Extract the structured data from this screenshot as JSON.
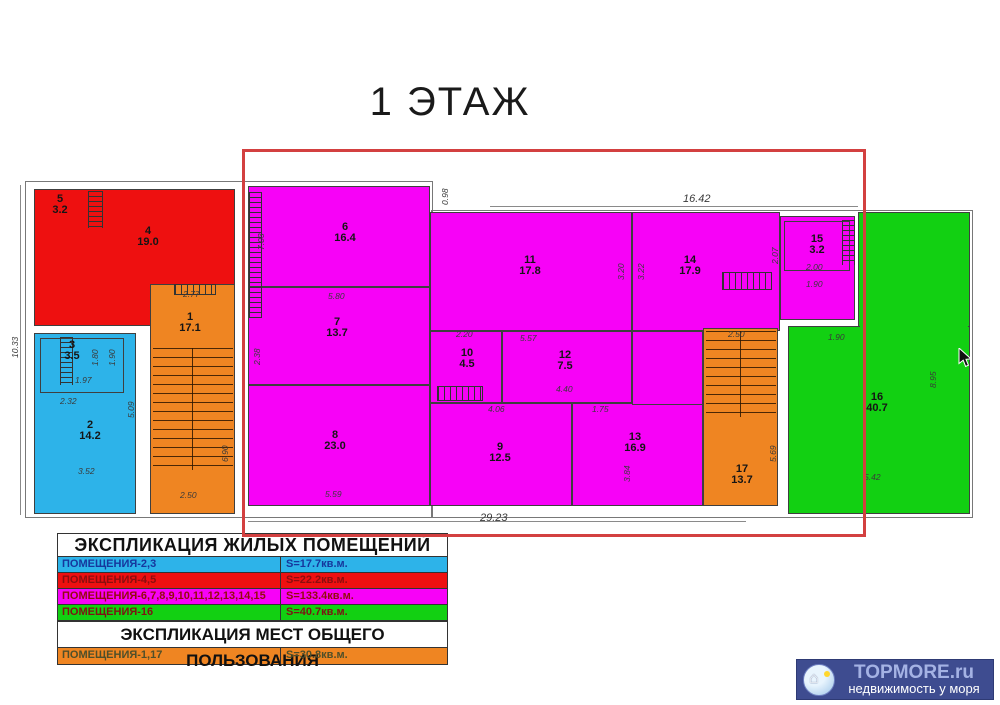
{
  "title": "1 ЭТАЖ",
  "plan": {
    "rooms": {
      "r1": {
        "num": "1",
        "area": "17.1"
      },
      "r2": {
        "num": "2",
        "area": "14.2"
      },
      "r3": {
        "num": "3",
        "area": "3.5"
      },
      "r4": {
        "num": "4",
        "area": "19.0"
      },
      "r5": {
        "num": "5",
        "area": "3.2"
      },
      "r6": {
        "num": "6",
        "area": "16.4"
      },
      "r7": {
        "num": "7",
        "area": "13.7"
      },
      "r8": {
        "num": "8",
        "area": "23.0"
      },
      "r9": {
        "num": "9",
        "area": "12.5"
      },
      "r10": {
        "num": "10",
        "area": "4.5"
      },
      "r11": {
        "num": "11",
        "area": "17.8"
      },
      "r12": {
        "num": "12",
        "area": "7.5"
      },
      "r13": {
        "num": "13",
        "area": "16.9"
      },
      "r14": {
        "num": "14",
        "area": "17.9"
      },
      "r15": {
        "num": "15",
        "area": "3.2"
      },
      "r16": {
        "num": "16",
        "area": "40.7"
      },
      "r17": {
        "num": "17",
        "area": "13.7"
      }
    },
    "dims": [
      {
        "t": "16.42",
        "x": 683,
        "y": 193,
        "big": 1
      },
      {
        "t": "0.98",
        "x": 440,
        "y": 205,
        "r": 1
      },
      {
        "t": "29.23",
        "x": 480,
        "y": 512,
        "big": 1
      },
      {
        "t": "10.33",
        "x": 10,
        "y": 358,
        "r": 1
      },
      {
        "t": "5.80",
        "x": 328,
        "y": 291
      },
      {
        "t": "5.57",
        "x": 520,
        "y": 333
      },
      {
        "t": "5.59",
        "x": 325,
        "y": 489
      },
      {
        "t": "4.06",
        "x": 488,
        "y": 404
      },
      {
        "t": "4.40",
        "x": 556,
        "y": 384
      },
      {
        "t": "2.20",
        "x": 456,
        "y": 329
      },
      {
        "t": "1.75",
        "x": 592,
        "y": 404
      },
      {
        "t": "2.77",
        "x": 183,
        "y": 289
      },
      {
        "t": "2.50",
        "x": 180,
        "y": 490
      },
      {
        "t": "6.90",
        "x": 220,
        "y": 462,
        "r": 1
      },
      {
        "t": "5.09",
        "x": 126,
        "y": 418,
        "r": 1
      },
      {
        "t": "1.97",
        "x": 75,
        "y": 375
      },
      {
        "t": "2.32",
        "x": 60,
        "y": 396
      },
      {
        "t": "3.52",
        "x": 78,
        "y": 466
      },
      {
        "t": "1.80",
        "x": 90,
        "y": 366,
        "r": 1
      },
      {
        "t": "1.90",
        "x": 107,
        "y": 366,
        "r": 1
      },
      {
        "t": "2.07",
        "x": 770,
        "y": 264,
        "r": 1
      },
      {
        "t": "2.00",
        "x": 806,
        "y": 262
      },
      {
        "t": "1.90",
        "x": 806,
        "y": 279
      },
      {
        "t": "2.50",
        "x": 728,
        "y": 329
      },
      {
        "t": "5.69",
        "x": 768,
        "y": 462,
        "r": 1
      },
      {
        "t": "8.95",
        "x": 928,
        "y": 388,
        "r": 1
      },
      {
        "t": "5.42",
        "x": 864,
        "y": 472
      },
      {
        "t": "1.90",
        "x": 828,
        "y": 332
      },
      {
        "t": "3.84",
        "x": 622,
        "y": 482,
        "r": 1
      },
      {
        "t": "7.03",
        "x": 256,
        "y": 250,
        "r": 1
      },
      {
        "t": "2.38",
        "x": 252,
        "y": 365,
        "r": 1
      },
      {
        "t": "3.22",
        "x": 636,
        "y": 280,
        "r": 1
      },
      {
        "t": "3.20",
        "x": 616,
        "y": 280,
        "r": 1
      }
    ]
  },
  "colors": {
    "red": "#ee1010",
    "blue": "#2db3e9",
    "magenta": "#f702f7",
    "green": "#12d012",
    "orange": "#ef8522",
    "highlight": "#d34040",
    "logo_bg": "#3e4c90"
  },
  "legend": {
    "title_residential": "ЭКСПЛИКАЦИЯ ЖИЛЫХ ПОМЕЩЕНИЙ",
    "title_common": "ЭКСПЛИКАЦИЯ МЕСТ ОБЩЕГО ПОЛЬЗОВАНИЯ",
    "rows": [
      {
        "label": "ПОМЕЩЕНИЯ-2,3",
        "value": "S=17.7кв.м.",
        "color": "#2db3e9",
        "text": "#16379d"
      },
      {
        "label": "ПОМЕЩЕНИЯ-4,5",
        "value": "S=22.2кв.м.",
        "color": "#ee1010",
        "text": "#8c0d0d"
      },
      {
        "label": "ПОМЕЩЕНИЯ-6,7,8,9,10,11,12,13,14,15",
        "value": "S=133.4кв.м.",
        "color": "#f702f7",
        "text": "#930c0c"
      },
      {
        "label": "ПОМЕЩЕНИЯ-16",
        "value": "S=40.7кв.м.",
        "color": "#12d012",
        "text": "#7d1414"
      }
    ],
    "common_row": {
      "label": "ПОМЕЩЕНИЯ-1,17",
      "value": "S=30.8кв.м.",
      "color": "#ef8522",
      "text": "#4f4f2a"
    }
  },
  "logo": {
    "brand": "TOPMORE.ru",
    "tagline": "недвижимость у моря"
  }
}
